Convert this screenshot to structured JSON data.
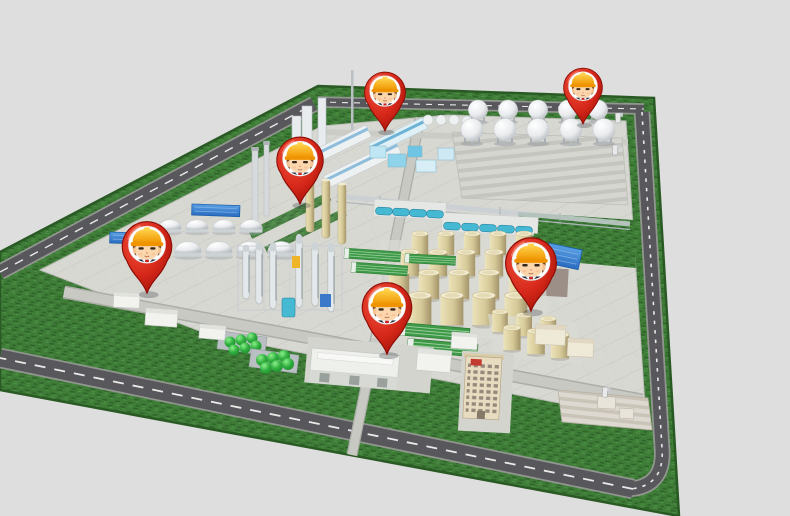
{
  "scene": {
    "description": "Isometric 3D rendering of an industrial plant campus on a green parcel with perimeter roads and six red worker location pins",
    "background_color": "#dedede"
  },
  "colors": {
    "background": "#dedede",
    "grass": "#3e7c38",
    "road": "#57575c",
    "road_line": "#f2f2f0",
    "pavement": "#d8d8d3",
    "pin_red_light": "#f0513d",
    "pin_red": "#d6281a",
    "pin_red_dark": "#9a0e05",
    "helmet_yellow": "#ffd24a",
    "helmet_orange": "#ef9400",
    "roof_green": "#3f9a48",
    "pool_blue": "#2a6cc0",
    "tank_tan": "#d6c998",
    "suit_navy": "#263140"
  },
  "markers": [
    {
      "id": "pin-processing-plant",
      "transform": "translate(385,131) scale(0.95)"
    },
    {
      "id": "pin-sphere-tank-farm",
      "transform": "translate(583,124) scale(0.9)"
    },
    {
      "id": "pin-distillation-area",
      "transform": "translate(300,204) scale(1.08)"
    },
    {
      "id": "pin-west-tank-area",
      "transform": "translate(147,293) scale(1.15)"
    },
    {
      "id": "pin-utility-area",
      "transform": "translate(387,354) scale(1.15)"
    },
    {
      "id": "pin-storage-tank-farm",
      "transform": "translate(531,311) scale(1.18)"
    }
  ],
  "marker_style": {
    "shape": "map-pin",
    "pin_color": "red",
    "icon": "construction-worker-face",
    "helmet": "yellow-hard-hat",
    "count": 6
  },
  "site_areas": [
    "processing-plant",
    "sphere-tank-farm",
    "striped-yard",
    "pipe-rack-area",
    "dome-tank-area",
    "distillation-columns",
    "storage-tank-farm",
    "green-roof-sheds",
    "green-sphere-units",
    "cooling-pools",
    "warehouse-area",
    "office-tower",
    "perimeter-road",
    "inner-road",
    "lawn"
  ]
}
